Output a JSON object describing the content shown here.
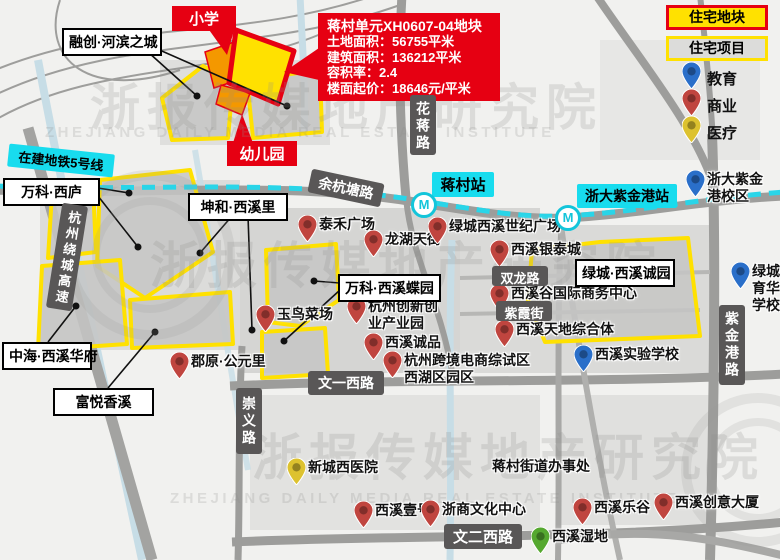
{
  "callout": {
    "title": "蒋村单元XH0607-04地块",
    "line1": "土地面积：56755平米",
    "line2": "建筑面积：136212平米",
    "line3": "容积率：2.4",
    "line4": "楼面起价：18646元/平米"
  },
  "legend": {
    "parcel": "住宅地块",
    "project": "住宅项目",
    "items": [
      {
        "label": "教育",
        "type": "education"
      },
      {
        "label": "商业",
        "type": "commerce"
      },
      {
        "label": "医疗",
        "type": "medical"
      }
    ]
  },
  "poi_colors": {
    "commerce": "#c0453f",
    "education": "#2a6fc9",
    "medical": "#ddc22f",
    "nature": "#55a82f"
  },
  "site_tags": [
    {
      "label": "小学",
      "x": 172,
      "y": 6,
      "w": 64
    },
    {
      "label": "幼儿园",
      "x": 227,
      "y": 141,
      "w": 70
    }
  ],
  "metro": {
    "line_tag": {
      "label": "在建地铁5号线",
      "x": 8,
      "y": 149,
      "w": 106,
      "rot": 6
    },
    "stations": [
      {
        "label": "蒋村站",
        "x": 432,
        "y": 172,
        "w": 62,
        "fs": 15
      },
      {
        "label": "浙大紫金港站",
        "x": 577,
        "y": 184,
        "w": 100,
        "fs": 14
      }
    ],
    "icons": [
      {
        "x": 411,
        "y": 192
      },
      {
        "x": 555,
        "y": 205
      }
    ],
    "icon_glyph": "M"
  },
  "road_labels": [
    {
      "label": "花蒋路",
      "x": 410,
      "y": 95,
      "w": 26,
      "h": 60,
      "vert": true,
      "fs": 14
    },
    {
      "label": "余杭塘路",
      "x": 309,
      "y": 176,
      "w": 74,
      "h": 24,
      "rot": 12,
      "fs": 14
    },
    {
      "label": "杭州绕城高速",
      "x": 54,
      "y": 204,
      "w": 26,
      "h": 106,
      "vert": true,
      "rot": 9,
      "fs": 13
    },
    {
      "label": "双龙路",
      "x": 492,
      "y": 266,
      "w": 56,
      "h": 20,
      "fs": 13
    },
    {
      "label": "紫霞街",
      "x": 496,
      "y": 301,
      "w": 56,
      "h": 20,
      "fs": 13
    },
    {
      "label": "文一西路",
      "x": 308,
      "y": 371,
      "w": 76,
      "h": 24,
      "fs": 14
    },
    {
      "label": "崇义路",
      "x": 236,
      "y": 388,
      "w": 26,
      "h": 66,
      "vert": true,
      "fs": 14
    },
    {
      "label": "紫金港路",
      "x": 719,
      "y": 305,
      "w": 26,
      "h": 80,
      "vert": true,
      "fs": 14
    },
    {
      "label": "文二西路",
      "x": 444,
      "y": 524,
      "w": 78,
      "h": 25,
      "fs": 15
    }
  ],
  "project_boxes": [
    {
      "label": "融创·河滨之城",
      "x": 62,
      "y": 28,
      "w": 100
    },
    {
      "label": "万科·西庐",
      "x": 3,
      "y": 178,
      "w": 97
    },
    {
      "label": "坤和·西溪里",
      "x": 188,
      "y": 193,
      "w": 100
    },
    {
      "label": "万科·西溪蝶园",
      "x": 338,
      "y": 274,
      "w": 103
    },
    {
      "label": "中海·西溪华府",
      "x": 2,
      "y": 342,
      "w": 90
    },
    {
      "label": "富悦香溪",
      "x": 53,
      "y": 388,
      "w": 101
    },
    {
      "label": "绿城·西溪诚园",
      "x": 575,
      "y": 259,
      "w": 100
    }
  ],
  "pois": [
    {
      "label": "泰禾广场",
      "type": "commerce",
      "x": 298,
      "y": 215
    },
    {
      "label": "龙湖天街",
      "type": "commerce",
      "x": 364,
      "y": 230
    },
    {
      "label": "绿城西溪世纪广场",
      "type": "commerce",
      "x": 428,
      "y": 217
    },
    {
      "label": "西溪银泰城",
      "type": "commerce",
      "x": 490,
      "y": 240
    },
    {
      "label": "西溪谷国际商务中心",
      "type": "commerce",
      "x": 490,
      "y": 284
    },
    {
      "label": "西溪天地综合体",
      "type": "commerce",
      "x": 495,
      "y": 320
    },
    {
      "label": "玉鸟菜场",
      "type": "commerce",
      "x": 256,
      "y": 305
    },
    {
      "label": "杭州创新创业产业园",
      "type": "commerce",
      "x": 347,
      "y": 297,
      "lines": [
        "杭州创新创",
        "业产业园"
      ]
    },
    {
      "label": "西溪诚品",
      "type": "commerce",
      "x": 364,
      "y": 333
    },
    {
      "label": "杭州跨境电商综试区西湖区园区",
      "type": "commerce",
      "x": 383,
      "y": 351,
      "lines": [
        "杭州跨境电商综试区",
        "西湖区园区"
      ]
    },
    {
      "label": "郡原·公元里",
      "type": "commerce",
      "x": 170,
      "y": 352
    },
    {
      "label": "西溪壹号",
      "type": "commerce",
      "x": 354,
      "y": 501
    },
    {
      "label": "浙商文化中心",
      "type": "commerce",
      "x": 421,
      "y": 500
    },
    {
      "label": "西溪乐谷",
      "type": "commerce",
      "x": 573,
      "y": 498
    },
    {
      "label": "西溪创意大厦",
      "type": "commerce",
      "x": 654,
      "y": 493
    },
    {
      "label": "浙大紫金港校区",
      "type": "education",
      "x": 686,
      "y": 170,
      "lines": [
        "浙大紫金",
        "港校区"
      ]
    },
    {
      "label": "绿城育华学校",
      "type": "education",
      "x": 731,
      "y": 262,
      "lines": [
        "绿城",
        "育华",
        "学校"
      ]
    },
    {
      "label": "西溪实验学校",
      "type": "education",
      "x": 574,
      "y": 345
    },
    {
      "label": "新城西医院",
      "type": "medical",
      "x": 287,
      "y": 458
    },
    {
      "label": "西溪湿地",
      "type": "nature",
      "x": 531,
      "y": 527
    }
  ],
  "office": {
    "label": "蒋村街道办事处",
    "x": 492,
    "y": 458
  },
  "watermark": {
    "cn": "浙报传媒地产研究院",
    "en": "ZHEJIANG DAILY MEDIA REAL ESTATE INSTITUTE"
  }
}
